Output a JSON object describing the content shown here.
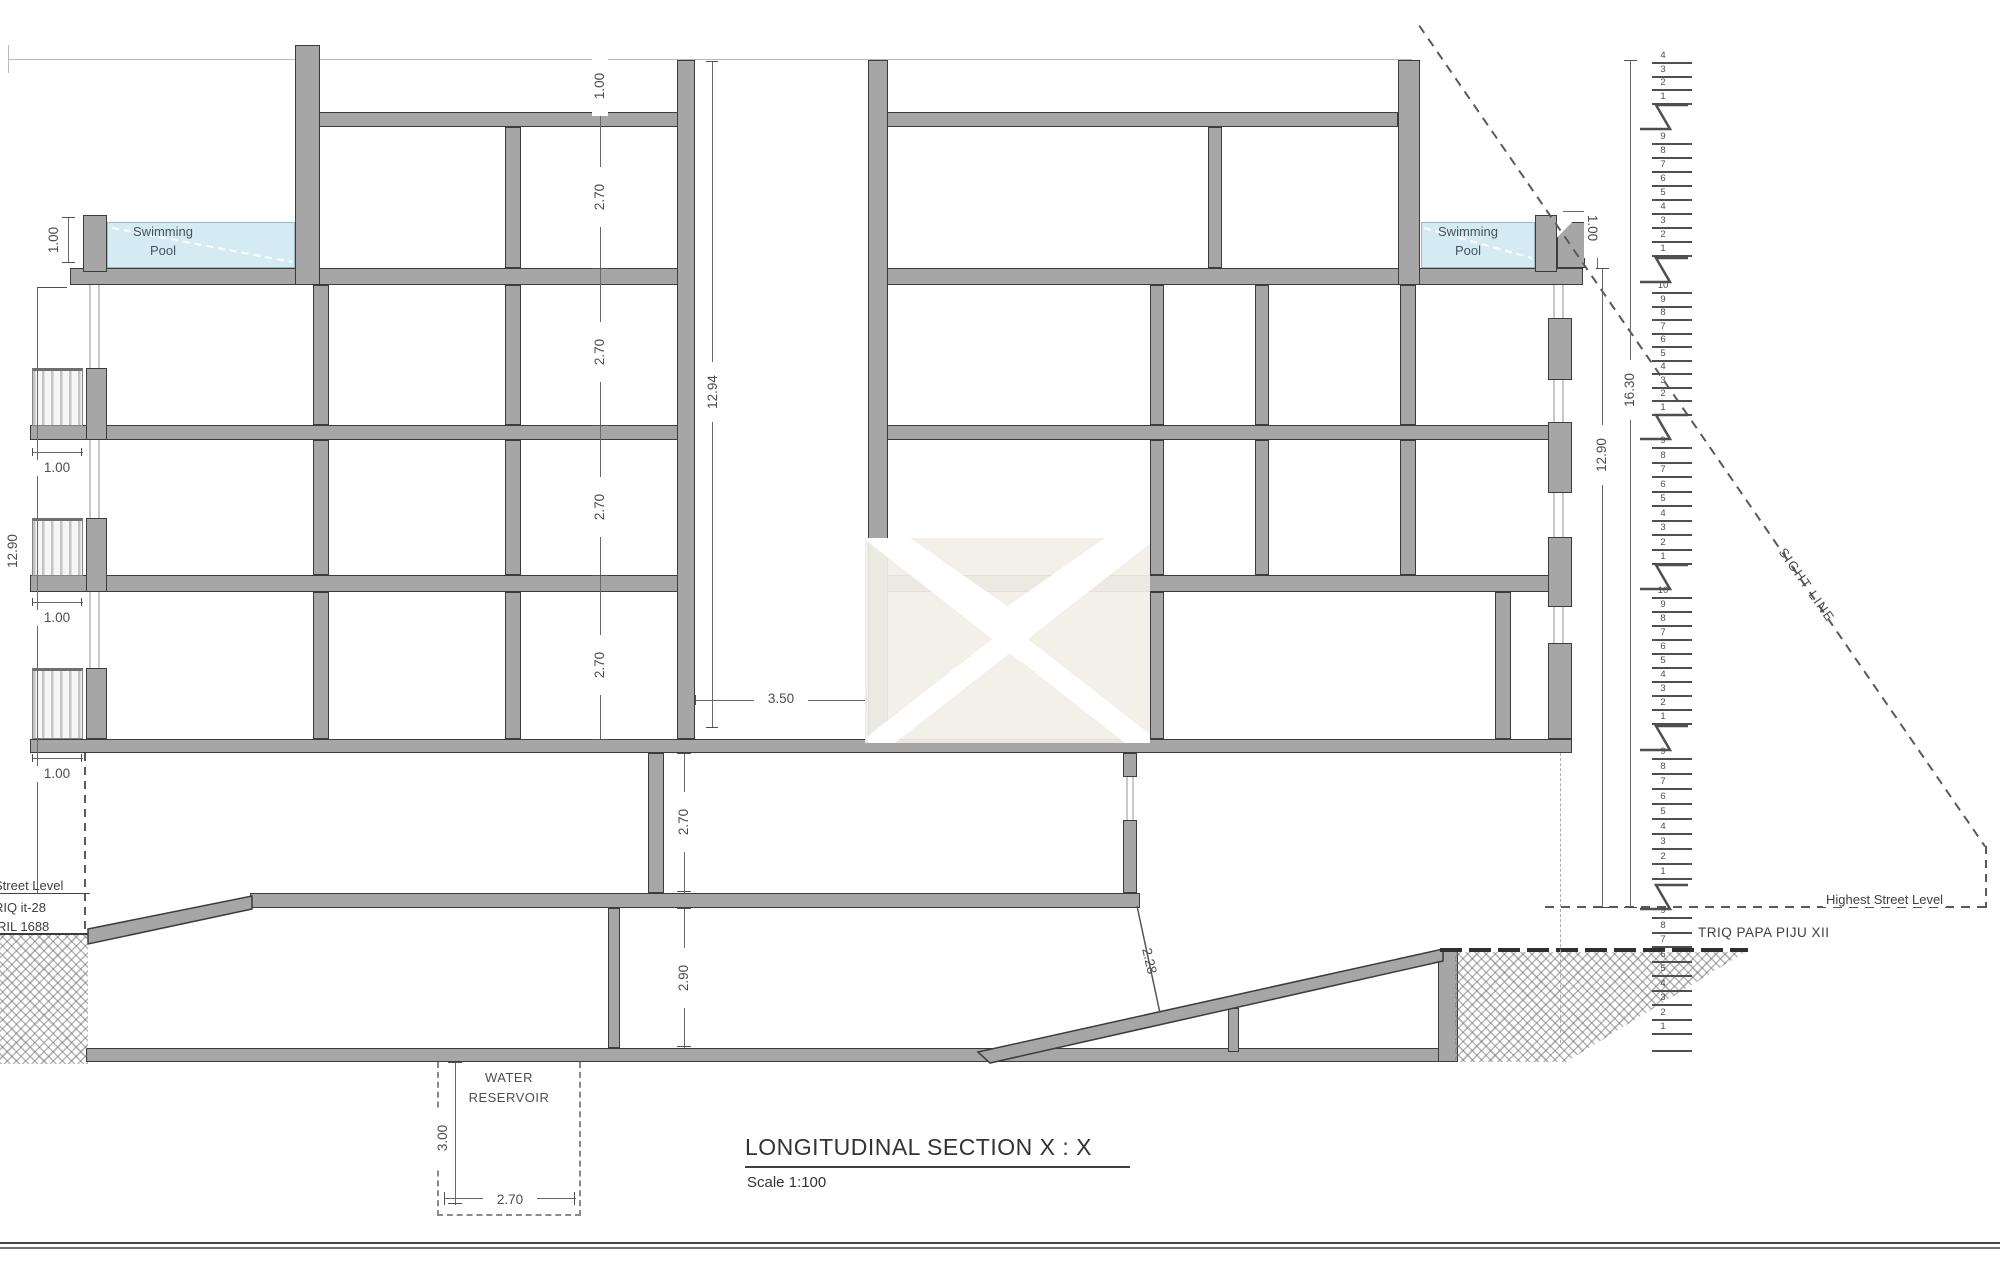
{
  "title": {
    "main": "LONGITUDINAL SECTION  X : X",
    "scale": "Scale 1:100"
  },
  "labels": {
    "swimming_line1": "Swimming",
    "swimming_line2": "Pool",
    "water_line1": "WATER",
    "water_line2": "RESERVOIR",
    "street_level": "Street Level",
    "street_name_left": "TRIQ it-28",
    "street_ref_left": "RIL 1688",
    "highest_street_level": "Highest Street Level",
    "street_name_right": "TRIQ PAPA PIJU XII",
    "sight_line": "SIGHT LINE"
  },
  "dimensions": {
    "parapet_height": "1.00",
    "floor_height": "2.70",
    "internal_height": "12.94",
    "left_total_height": "12.90",
    "gap_width": "3.50",
    "balcony_width": "1.00",
    "pool_depth": "1.00",
    "pool_parapet_right": "1.00",
    "basement_height": "2.70",
    "subbasement_height": "2.90",
    "ramp_clearance": "2.28",
    "right_total_height": "12.90",
    "right_overall_height": "16.30",
    "reservoir_depth": "3.00",
    "reservoir_width": "2.70"
  },
  "stairs": {
    "flights": [
      {
        "top": 62,
        "n": 4,
        "s": 13.5
      },
      {
        "top": 143,
        "n": 9,
        "s": 14
      },
      {
        "top": 292,
        "n": 10,
        "s": 13.5
      },
      {
        "top": 447,
        "n": 9,
        "s": 14.5
      },
      {
        "top": 597,
        "n": 10,
        "s": 14
      },
      {
        "top": 758,
        "n": 9,
        "s": 15
      },
      {
        "top": 917,
        "n": 9,
        "s": 14.5
      }
    ],
    "landings": [
      117,
      270,
      427,
      577,
      738,
      897
    ],
    "baseline": 1050
  },
  "colors": {
    "pool_water": "#d4ebf4",
    "structure_fill": "#a6a6a6",
    "structure_line": "#3c3c3c",
    "dim_line": "#686868",
    "watermark_bg": "#f2efe8"
  }
}
